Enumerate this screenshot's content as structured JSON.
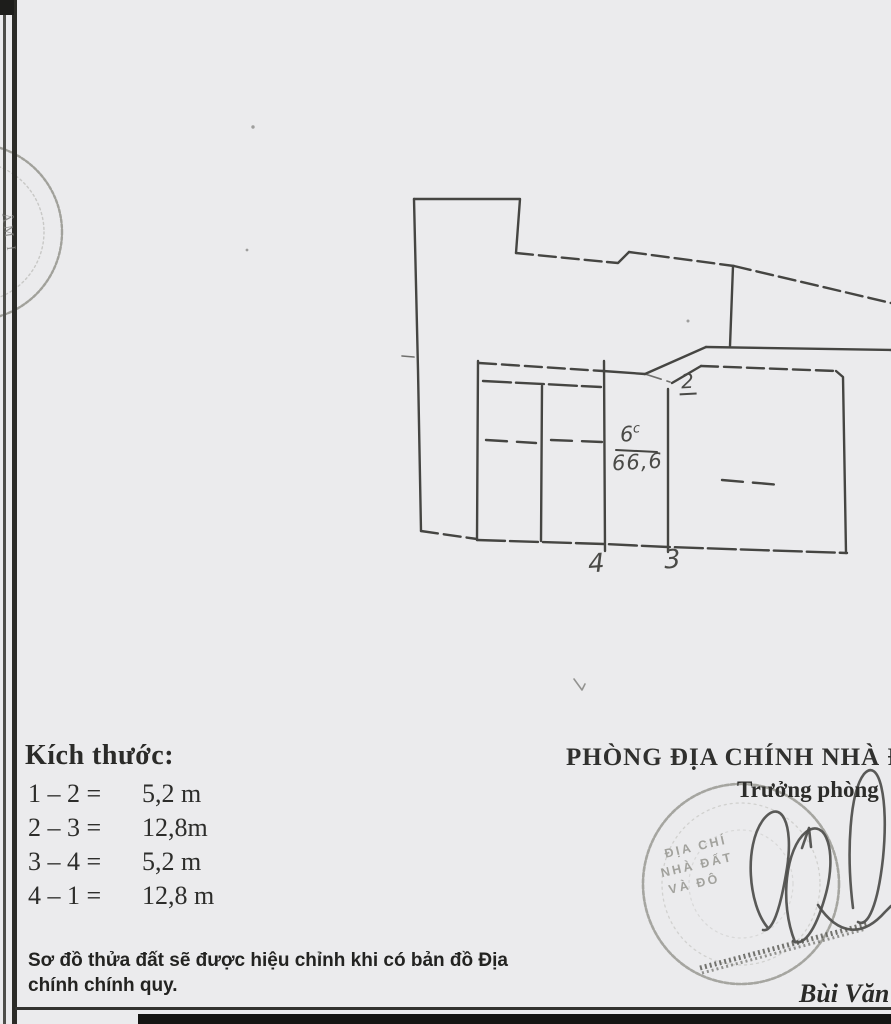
{
  "dimensions": {
    "heading": "Kích thước:",
    "rows": [
      {
        "label": "1 – 2 =",
        "value": "5,2 m"
      },
      {
        "label": "2 – 3 =",
        "value": "12,8m"
      },
      {
        "label": "3 – 4 =",
        "value": "5,2 m"
      },
      {
        "label": "4 – 1 =",
        "value": "12,8 m"
      }
    ]
  },
  "note": "Sơ đồ thửa đất sẽ được hiệu chỉnh khi có bản đồ Địa chính chính quy.",
  "office": {
    "department": "PHÒNG ĐỊA CHÍNH NHÀ Đ",
    "title": "Trưởng phòng",
    "signer": "Bùi Văn B"
  },
  "parcel": {
    "number": "6",
    "number_sup": "c",
    "area": "66,6",
    "points": {
      "p2": "2",
      "p3": "3",
      "p4": "4"
    }
  },
  "stamps": {
    "office_stamp_lines": [
      "ĐỊA CHÍ",
      "NHÀ ĐẤT",
      "VÀ ĐÔ"
    ],
    "margin_stamp_text": "ÂM I"
  },
  "colors": {
    "background": "#ebebed",
    "ink": "#454542",
    "stamp_gray": "#94948c",
    "scan_bar": "#151513"
  }
}
